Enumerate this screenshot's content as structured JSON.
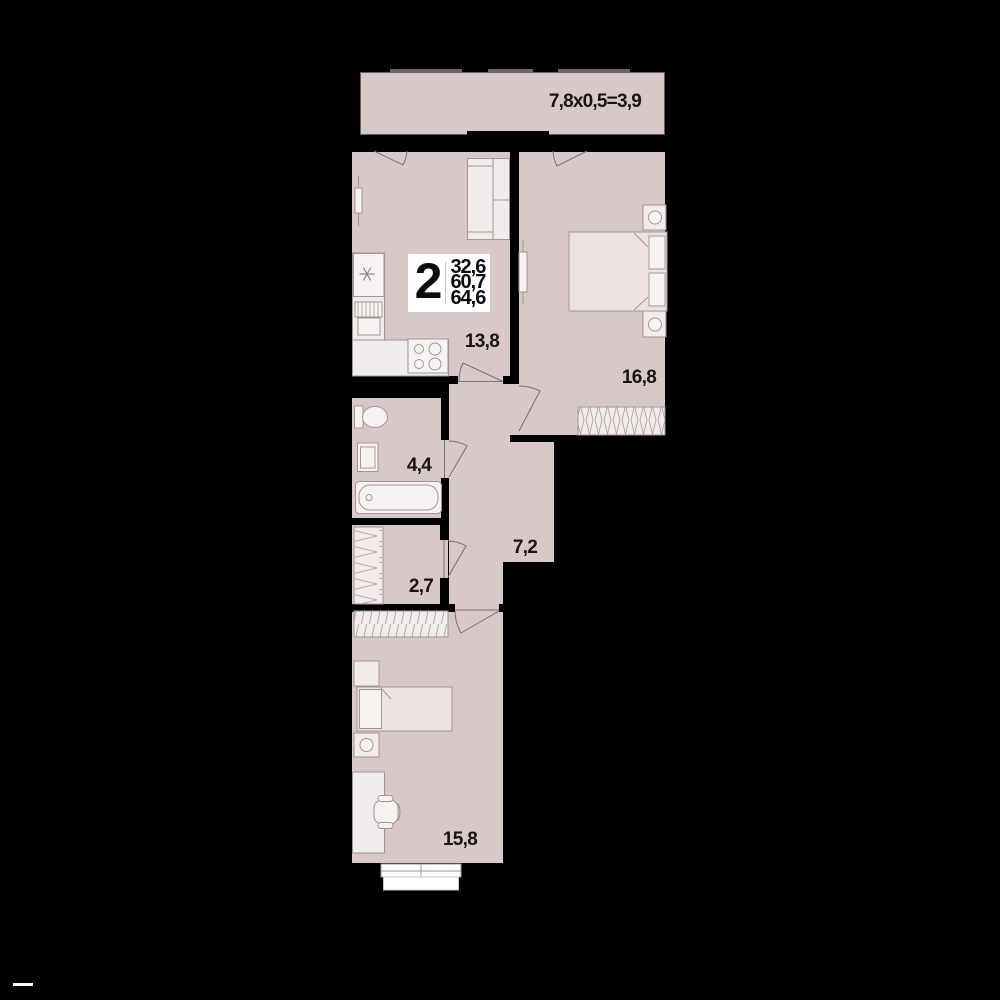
{
  "colors": {
    "bg": "#000000",
    "floor": "#d9c8c8",
    "wall": "#000000",
    "furn": "#f2ebeb",
    "furn2": "#f7f2f2",
    "bedfill": "#ece2e2",
    "stroke": "#a39595",
    "arc": "#7a6e6e",
    "label": "#171414",
    "badge_bg": "#ffffff",
    "balc_border": "#6b5e5e"
  },
  "badge": {
    "room_count": "2",
    "areas": [
      "32,6",
      "60,7",
      "64,6"
    ]
  },
  "balcony": {
    "label": "7,8x0,5=3,9"
  },
  "rooms": {
    "kitchen": {
      "area": "13,8"
    },
    "bedroom": {
      "area": "16,8"
    },
    "bathroom": {
      "area": "4,4"
    },
    "hallway": {
      "area": "7,2"
    },
    "storage": {
      "area": "2,7"
    },
    "living": {
      "area": "15,8"
    }
  }
}
